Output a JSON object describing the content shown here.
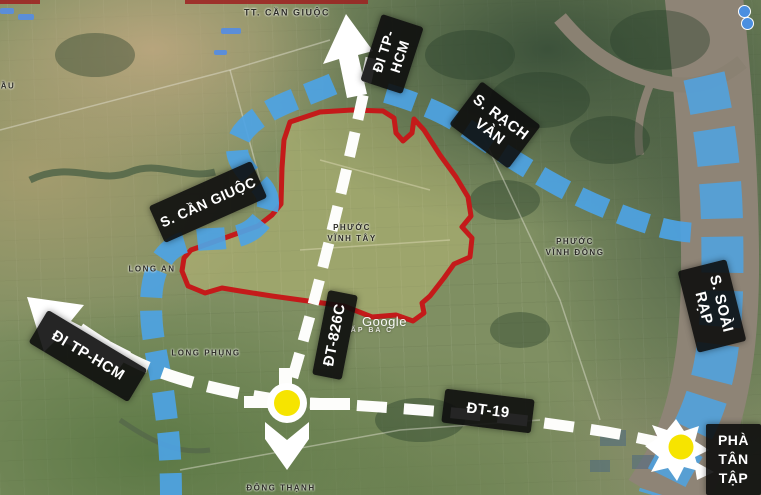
{
  "route_labels": {
    "north": {
      "lines": [
        "ĐI TP-",
        "HCM"
      ]
    },
    "west": {
      "text": "ĐI TP-HCM"
    },
    "rach_van": {
      "lines": [
        "S. RẠCH",
        "VÀN"
      ]
    },
    "can_giuoc": {
      "text": "S. CẦN GIUỘC"
    },
    "soai_rap": {
      "lines": [
        "S. SOÀI",
        "RẠP"
      ]
    },
    "dt826c": {
      "text": "ĐT-826C"
    },
    "dt19": {
      "text": "ĐT-19"
    },
    "ferry": {
      "lines": [
        "PHÀ",
        "TÂN",
        "TẬP"
      ]
    }
  },
  "place_labels": {
    "town": "TT. CẦN GIUỘC",
    "phuoc_vinh_tay": {
      "lines": [
        "PHƯỚC",
        "VĨNH TÂY"
      ]
    },
    "phuoc_vinh_dong": {
      "lines": [
        "PHƯỚC",
        "VĨNH ĐÔNG"
      ]
    },
    "long_phung": "LONG PHỤNG",
    "dong_thanh": "ĐÔNG THẠNH",
    "long_an": "LONG AN",
    "ap_ba": "ẤP BA C",
    "edge_fragment": "ẦU"
  },
  "watermark": "Google",
  "icons": {
    "poi_marker": "blue-circle",
    "road_badge": "blue-rect",
    "junction": "yellow-circle",
    "direction_arrows": "white-arrow"
  },
  "colors": {
    "waterway_highlight": "#4da3e4",
    "road_highlight": "#fdfdfb",
    "boundary": "#c41a1a",
    "boundary_fill": "rgba(219,209,130,0.33)",
    "junction": "#f6e400",
    "label_bg": "#111111",
    "label_text": "#ffffff"
  }
}
